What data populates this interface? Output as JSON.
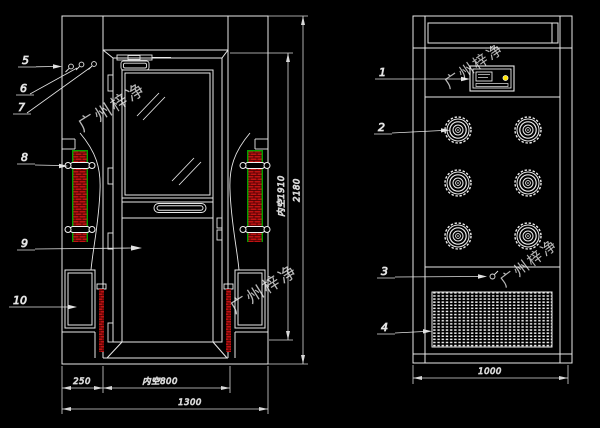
{
  "drawing": {
    "watermark": {
      "text": "广州梓净"
    },
    "callouts": {
      "c1": "1",
      "c2": "2",
      "c3": "3",
      "c4": "4",
      "c5": "5",
      "c6": "6",
      "c7": "7",
      "c8": "8",
      "c9": "9",
      "c10": "10"
    },
    "dimensions": {
      "left_column_width": "250",
      "door_clear_width": "内空800",
      "total_width": "1300",
      "inner_clear_height": "内空1910",
      "total_height": "2180",
      "side_depth": "1000"
    },
    "colors": {
      "background": "#000000",
      "line": "#e8e8e8",
      "hatch_red": "#c01212",
      "edge_green": "#00a000",
      "indicator_yellow": "#ffe400"
    }
  }
}
